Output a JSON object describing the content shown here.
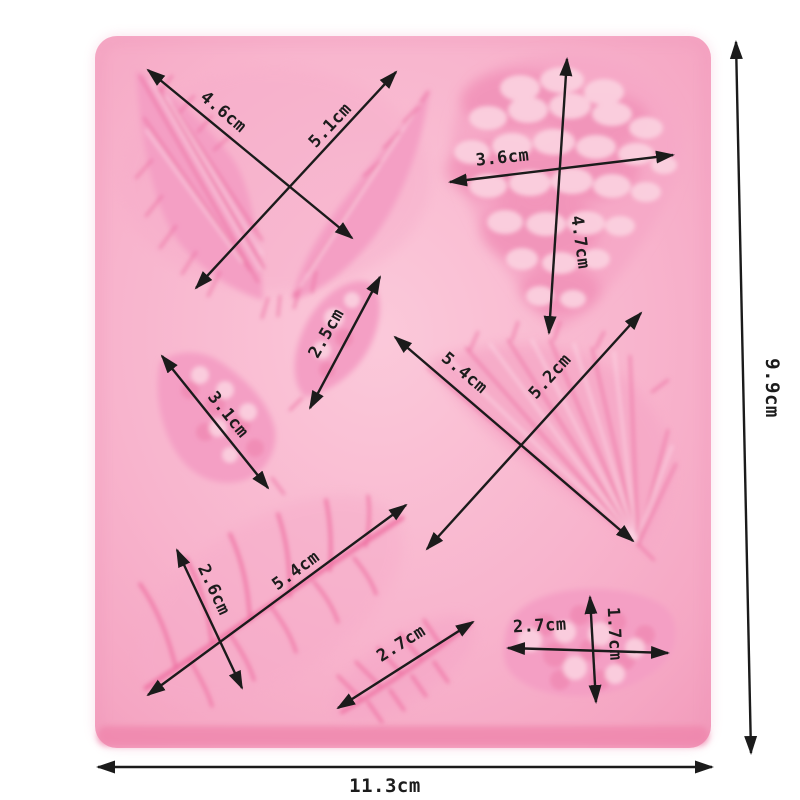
{
  "scene": {
    "description": "Top-down product photo of a pink silicone fondant mould with eight leaf and pine-cone shaped cavities, annotated with black double-headed dimension arrows",
    "colors": {
      "background": "#ffffff",
      "mold_base": "#f8b6ce",
      "mold_highlight": "#fbc9da",
      "mold_edge": "#ef84ab",
      "cavity_dark": "#ec6fa2",
      "cavity_mid": "#f49fc4",
      "cavity_light": "#fbd2e0",
      "annotation": "#1b1b1b"
    }
  },
  "annotations": {
    "maple_leaf": {
      "d1": "4.6cm",
      "d2": "5.1cm"
    },
    "pine_cone": {
      "width": "3.6cm",
      "height": "4.7cm"
    },
    "small_leaf": {
      "d": "2.5cm"
    },
    "cone_leaf": {
      "d": "3.1cm"
    },
    "carnation_leaf": {
      "d1": "5.4cm",
      "d2": "5.2cm"
    },
    "fern_leaf": {
      "width": "2.6cm",
      "length": "5.4cm"
    },
    "feather_leaf": {
      "d": "2.7cm"
    },
    "oval_cone": {
      "width": "2.7cm",
      "height": "1.7cm"
    },
    "overall": {
      "width": "11.3cm",
      "height": "9.9cm"
    }
  }
}
